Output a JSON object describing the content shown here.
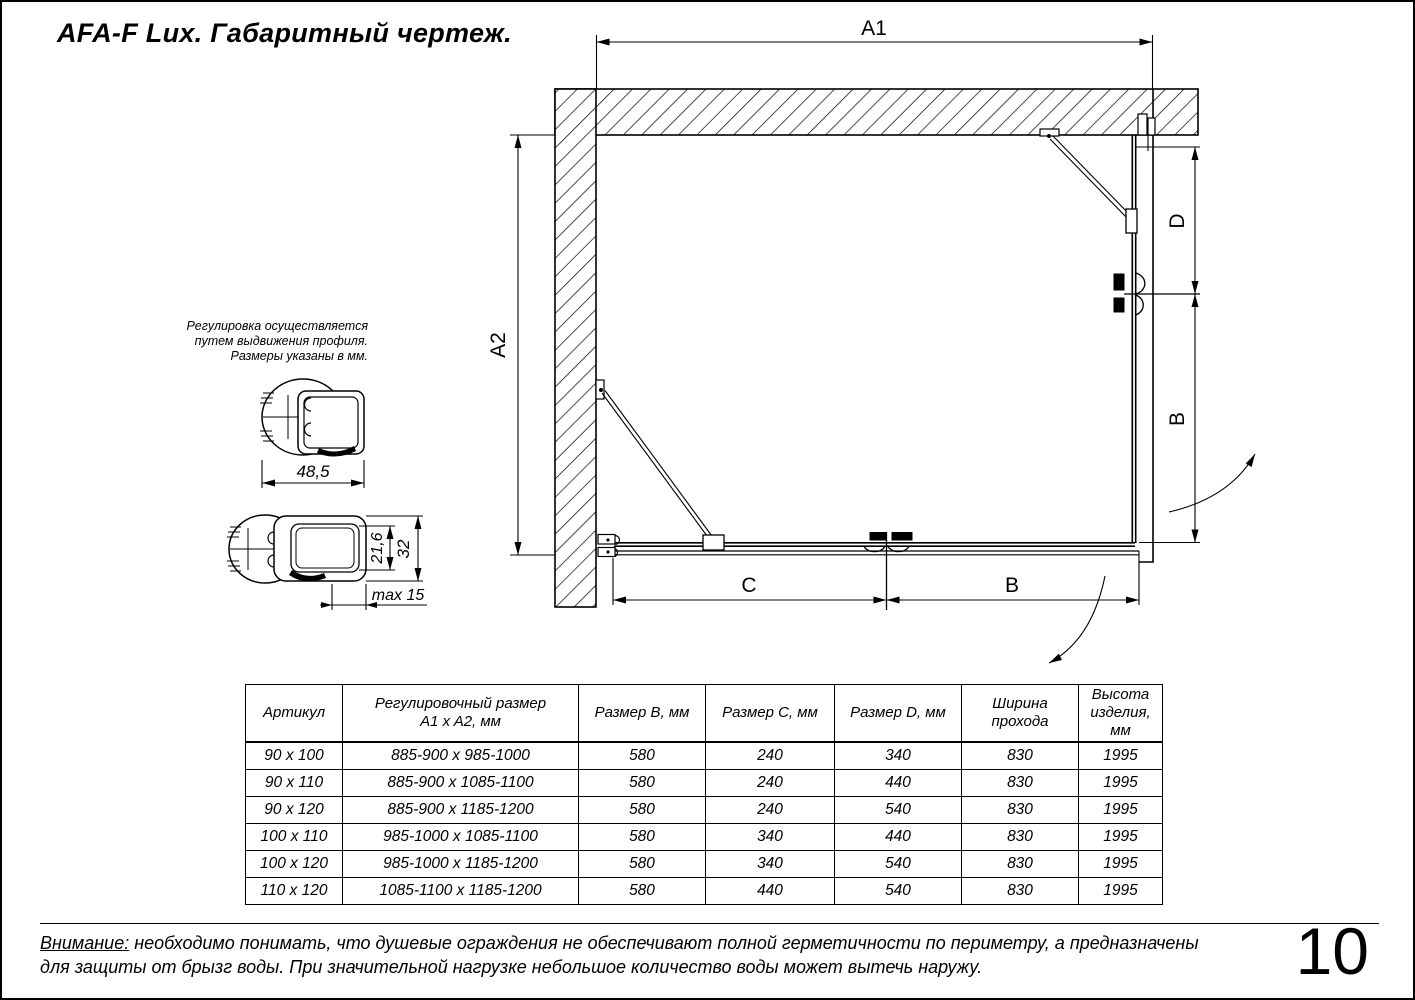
{
  "title": "AFA-F Lux. Габаритный чертеж.",
  "note": {
    "line1": "Регулировка осуществляется",
    "line2": "путем выдвижения профиля.",
    "line3": "Размеры указаны в мм."
  },
  "drawing": {
    "dim_a1": "A1",
    "dim_a2": "A2",
    "dim_d": "D",
    "dim_b_right": "B",
    "dim_c": "C",
    "dim_b_bottom": "B"
  },
  "profile_top": {
    "width": "48,5"
  },
  "profile_bottom": {
    "inner_height": "21,6",
    "outer_height": "32",
    "extension": "max 15"
  },
  "table": {
    "headers": [
      "Артикул",
      "Регулировочный размер\nA1 x A2, мм",
      "Размер B, мм",
      "Размер C, мм",
      "Размер D, мм",
      "Ширина\nпрохода",
      "Высота\nизделия,\nмм"
    ],
    "rows": [
      [
        "90 x 100",
        "885-900 x 985-1000",
        "580",
        "240",
        "340",
        "830",
        "1995"
      ],
      [
        "90 x 110",
        "885-900 x 1085-1100",
        "580",
        "240",
        "440",
        "830",
        "1995"
      ],
      [
        "90 x 120",
        "885-900 x 1185-1200",
        "580",
        "240",
        "540",
        "830",
        "1995"
      ],
      [
        "100 x 110",
        "985-1000 x 1085-1100",
        "580",
        "340",
        "440",
        "830",
        "1995"
      ],
      [
        "100 x 120",
        "985-1000 x 1185-1200",
        "580",
        "340",
        "540",
        "830",
        "1995"
      ],
      [
        "110 x 120",
        "1085-1100 x 1185-1200",
        "580",
        "440",
        "540",
        "830",
        "1995"
      ]
    ]
  },
  "warning": {
    "label": "Внимание:",
    "line1_rest": " необходимо понимать, что душевые ограждения не обеспечивают полной герметичности по периметру, а предназначены",
    "line2": "для защиты от брызг воды. При значительной нагрузке небольшое количество воды может вытечь наружу."
  },
  "page_number": "10"
}
